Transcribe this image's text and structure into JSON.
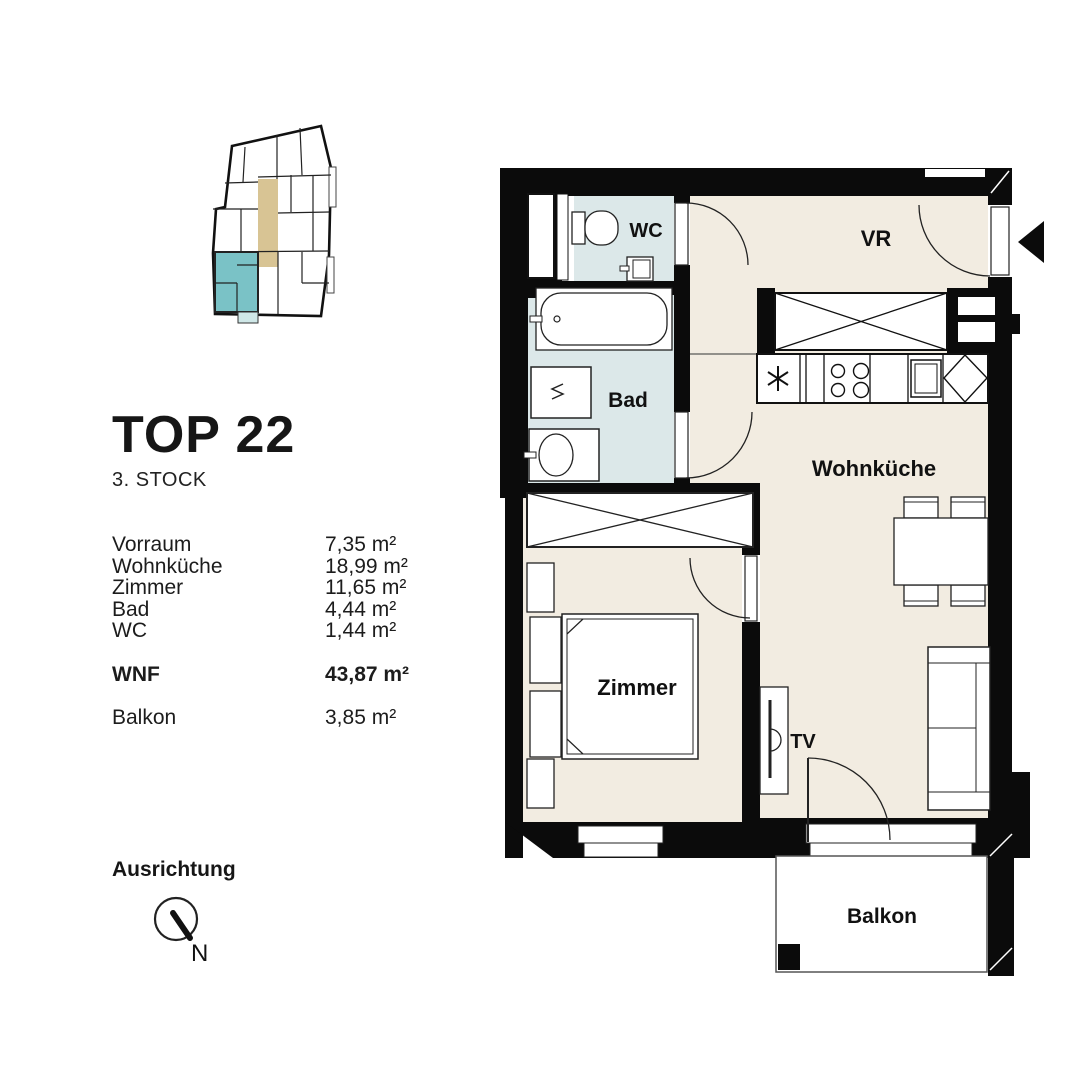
{
  "title": {
    "text": "TOP 22",
    "floor": "3. STOCK"
  },
  "areas": {
    "rows": [
      {
        "label": "Vorraum",
        "value": "7,35 m²"
      },
      {
        "label": "Wohnküche",
        "value": "18,99 m²"
      },
      {
        "label": "Zimmer",
        "value": "11,65 m²"
      },
      {
        "label": "Bad",
        "value": "4,44 m²"
      },
      {
        "label": "WC",
        "value": "1,44 m²"
      }
    ],
    "total": {
      "label": "WNF",
      "value": "43,87 m²"
    },
    "extra": {
      "label": "Balkon",
      "value": "3,85 m²"
    }
  },
  "orientation": {
    "label": "Ausrichtung",
    "north": "N"
  },
  "plan": {
    "labels": {
      "wc": "WC",
      "vr": "VR",
      "bad": "Bad",
      "wohnkueche": "Wohnküche",
      "zimmer": "Zimmer",
      "tv": "TV",
      "balkon": "Balkon"
    },
    "colors": {
      "wall": "#0b0b0b",
      "room_cream": "#f2ece1",
      "room_wet": "#dce8e9",
      "unit_highlight": "#7ac2c6",
      "corridor": "#d8c494",
      "unit_balcony": "#cfe7e7"
    }
  }
}
